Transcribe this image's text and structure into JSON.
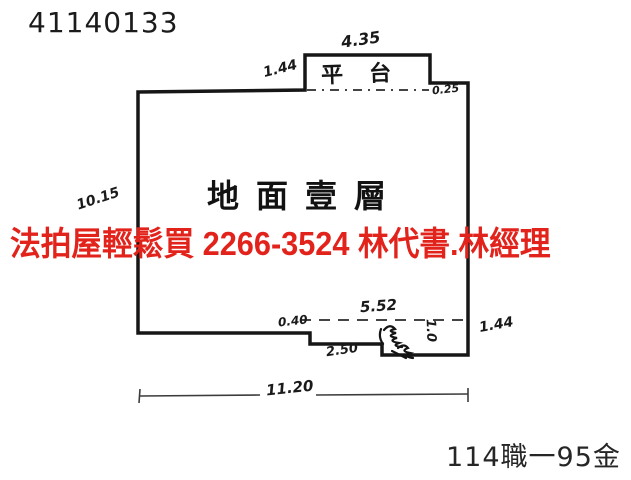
{
  "document": {
    "number": "41140133",
    "reference": "114職一95金"
  },
  "watermark": {
    "text": "法拍屋輕鬆買  2266-3524  林代書.林經理",
    "color": "#e2231c"
  },
  "plan": {
    "floor_label": "地面壹層",
    "area_label": "平台",
    "line_color": "#161616",
    "dimensions": {
      "top_width": "4.35",
      "top_left_side": "1.44",
      "notch_right_offset": "0.25",
      "left_height": "10.15",
      "entry_recess_width": "5.52",
      "step_left_depth": "0.40",
      "step_width": "2.50",
      "entry_small": "1.0",
      "right_side": "1.44",
      "bottom_width": "11.20"
    }
  }
}
